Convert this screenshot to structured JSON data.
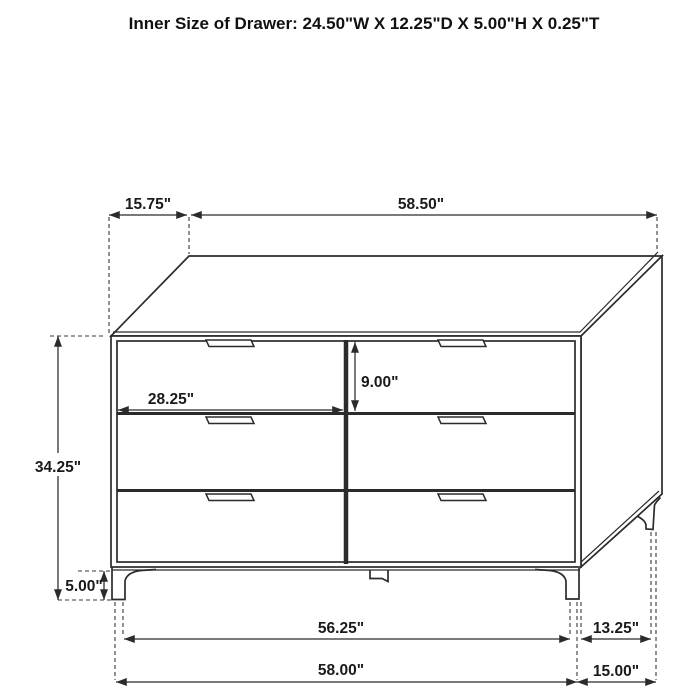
{
  "title": "Inner Size of Drawer: 24.50\"W X 12.25\"D X 5.00\"H X 0.25\"T",
  "diagram": {
    "type": "furniture-dimension-diagram",
    "subject": "6-drawer dresser, 3D line drawing with dimension callouts",
    "dimensions": {
      "top_depth_offset": "15.75\"",
      "top_width": "58.50\"",
      "body_height": "34.25\"",
      "leg_height": "5.00\"",
      "drawer_front_width": "28.25\"",
      "drawer_front_height": "9.00\"",
      "base_inner_width": "56.25\"",
      "overall_width": "58.00\"",
      "side_leg_span": "13.25\"",
      "overall_depth": "15.00\""
    },
    "inner_drawer_size": {
      "width": "24.50\"W",
      "depth": "12.25\"D",
      "height": "5.00\"H",
      "thickness": "0.25\"T"
    },
    "colors": {
      "line": "#2b2b2b",
      "background": "#ffffff",
      "text": "#1a1a1a"
    }
  }
}
